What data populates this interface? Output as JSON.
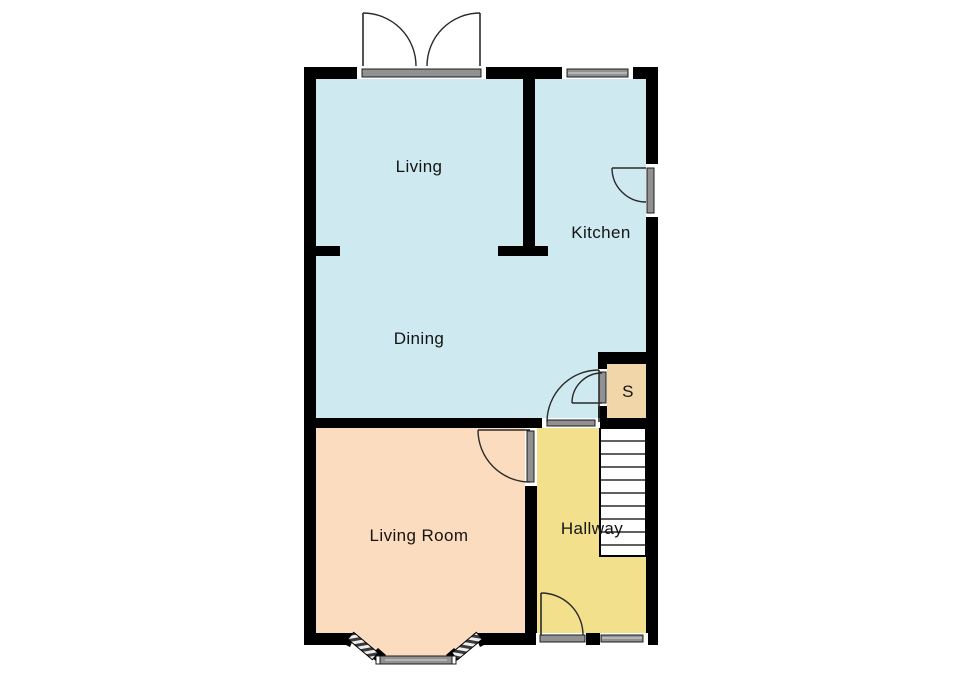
{
  "floorplan": {
    "background": "#ffffff",
    "wall_color": "#000000",
    "window_color": "#919191",
    "window_outline_color": "#1c1c1c",
    "door_line_color": "#2a2a2a",
    "rooms": [
      {
        "id": "living",
        "label": "Living",
        "fill": "#cee9ef"
      },
      {
        "id": "kitchen",
        "label": "Kitchen",
        "fill": "#cee9ef"
      },
      {
        "id": "dining",
        "label": "Dining",
        "fill": "#cee9ef"
      },
      {
        "id": "storage",
        "label": "S",
        "fill": "#f0d6a8"
      },
      {
        "id": "living_room",
        "label": "Living Room",
        "fill": "#fcdcbe"
      },
      {
        "id": "hallway",
        "label": "Hallway",
        "fill": "#f2e08c"
      }
    ],
    "stairs": {
      "tread_count": 10,
      "fill": "#ffffff"
    },
    "openings": [
      "french-doors",
      "kitchen-window",
      "kitchen-door",
      "storage-door",
      "hallway-door",
      "living-room-door",
      "front-door",
      "front-window",
      "bay-window"
    ]
  }
}
